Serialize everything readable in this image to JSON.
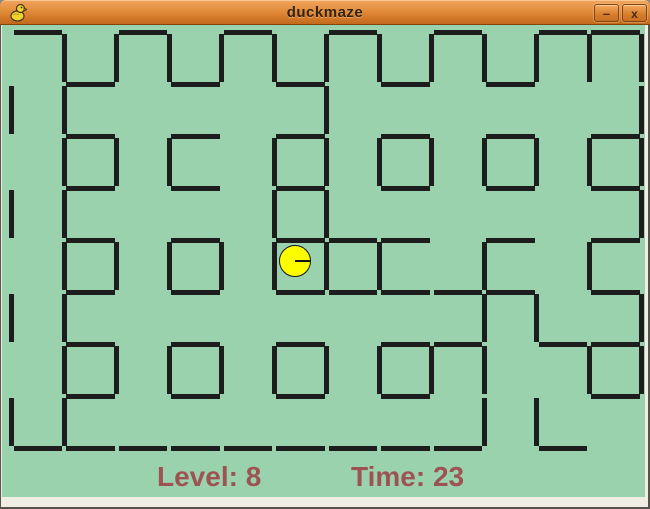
{
  "window": {
    "width": 650,
    "height": 509
  },
  "titlebar": {
    "title": "duckmaze",
    "app_icon": "duck-icon",
    "minimize_glyph": "–",
    "close_glyph": "x"
  },
  "status": {
    "level_label": "Level: 8",
    "time_label": "Time: 23"
  },
  "colors": {
    "titlebar_orange_top": "#f2a55e",
    "titlebar_orange_bottom": "#bf671c",
    "frame_cream": "#f0ede3",
    "outer_edge": "#55534b",
    "maze_background": "#9ad2ae",
    "wall": "#1d1d1d",
    "duck_fill": "#fdfd00",
    "duck_outline": "#151515",
    "status_text": "#9e5353",
    "title_text": "#33220c"
  },
  "maze": {
    "cols": 12,
    "rows": 8,
    "origin_x": 11.5,
    "origin_y": 32,
    "cell_w": 52.5,
    "cell_h": 52,
    "wall_thickness": 5,
    "wall_inset": 2,
    "h_walls": [
      "101010101011",
      "010101010100",
      "010101010101",
      "010101010101",
      "010101110101",
      "010101111101",
      "010101011011",
      "010101010001",
      "111111111010"
    ],
    "v_walls": [
      "0111111111111",
      "1100001000001",
      "0111011111111",
      "1100011000001",
      "0111111101010",
      "1100000001101",
      "0111111111011",
      "1100000001100"
    ]
  },
  "duck": {
    "cx": 295,
    "cy": 261,
    "r": 16,
    "facing": "right"
  }
}
